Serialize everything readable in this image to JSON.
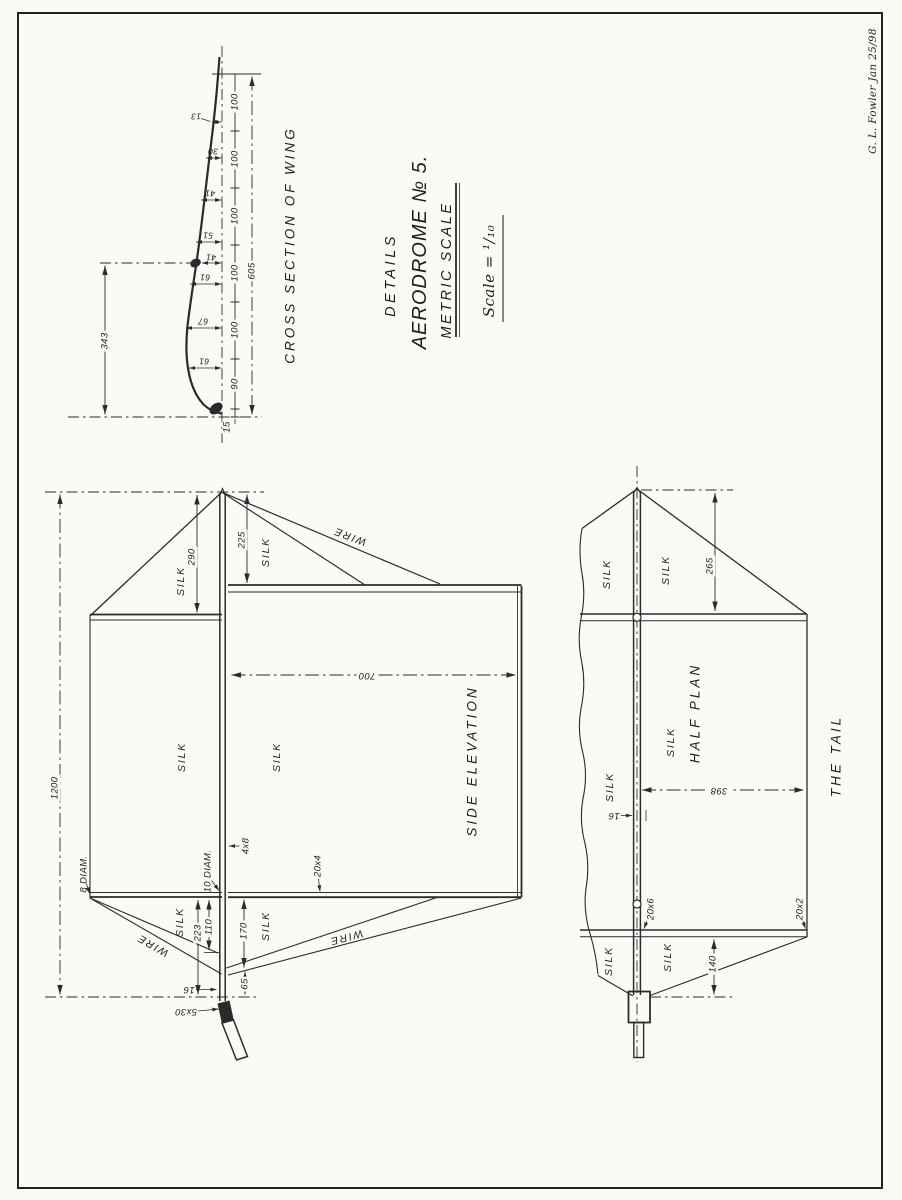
{
  "plate": {
    "signature": "G. L. Fowler   Jan 25/98"
  },
  "title_block": {
    "details": "DETAILS",
    "title": "AERODROME № 5.",
    "subtitle": "METRIC SCALE",
    "scale_note": "Scale = ¹/₁₀"
  },
  "cross_section": {
    "title": "CROSS SECTION OF WING",
    "chord_total": "605",
    "camber_height": "343",
    "stations": [
      "100",
      "100",
      "100",
      "100",
      "100",
      "90",
      "15"
    ],
    "ordinates": [
      "13",
      "30",
      "41",
      "51",
      "41",
      "61",
      "67",
      "61"
    ]
  },
  "side_elevation": {
    "caption": "SIDE ELEVATION",
    "silk": "SILK",
    "wire": "WIRE",
    "dims": {
      "overall": "1200",
      "fin_front": "290",
      "fin_rear": "225",
      "depth": "700",
      "mast_head": "8 DIAM.",
      "mast_foot": "10 DIAM.",
      "boom": "4x8",
      "edge": "20x4",
      "lower_front": "223",
      "lower_mid": "110",
      "lower_rear": "170",
      "lower_tip": "65",
      "keel": "16",
      "stick": "5x30"
    }
  },
  "half_plan": {
    "caption": "HALF PLAN",
    "figure_caption": "THE TAIL",
    "silk": "SILK",
    "dims": {
      "tip_offset": "265",
      "half_span": "398",
      "keel_width": "16",
      "rib": "20x6",
      "edge": "20x2",
      "tail_point": "140"
    }
  }
}
